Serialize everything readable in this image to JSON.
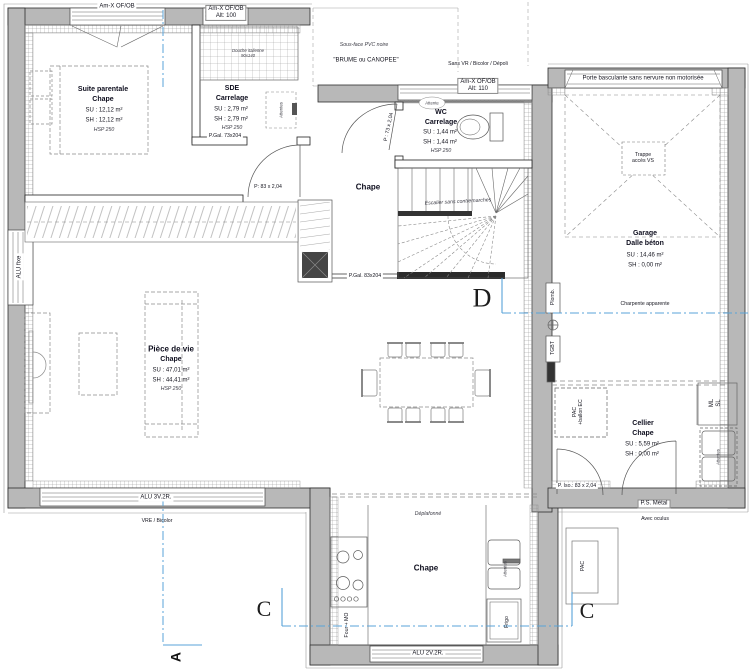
{
  "colors": {
    "wall_fill": "#b8b8b8",
    "section_blue": "#58a3d8",
    "ink": "#15151f"
  },
  "windows": {
    "w1": "Am-X OF/OB",
    "w2_line1": "Am-X OF/OB",
    "w2_line2": "Alt: 100",
    "w3_line1": "Am-X OF/OB",
    "w3_line2": "Alt: 110",
    "w3_note": "Sans VR / Bicolor / Dépoli",
    "alu_fixe": "ALU fixe",
    "alu_3v": "ALU 3V.2R.",
    "alu_3v_note": "VRE / Bicolor",
    "alu_2v": "ALU 2V.2R."
  },
  "doors": {
    "garage_door": "Porte basculante sans nervure non motorisée",
    "p_gal_sde": "P.Gal. 73x204",
    "p_suite": "P: 83 x 2,04",
    "p_wc": "P : 73 x 2,04",
    "p_gal_hall": "P.Gal. 83x204",
    "p_iso": "P. Iso.: 83 x 2,04",
    "ps_metal": "P.S. Métal",
    "ps_metal_note": "Avec oculus"
  },
  "rooms": {
    "suite": {
      "name": "Suite parentale",
      "floor": "Chape",
      "su": "SU : 12,12 m²",
      "sh": "SH : 12,12 m²",
      "hsp": "HSP 250"
    },
    "sde": {
      "name": "SDE",
      "floor": "Carrelage",
      "su": "SU : 2,79 m²",
      "sh": "SH : 2,79 m²",
      "hsp": "HSP 250"
    },
    "wc": {
      "name": "WC",
      "floor": "Carrelage",
      "su": "SU : 1,44 m²",
      "sh": "SH : 1,44 m²",
      "hsp": "HSP 250"
    },
    "hall": {
      "floor": "Chape"
    },
    "living": {
      "name": "Pièce de vie",
      "floor": "Chape",
      "su": "SU : 47,01 m²",
      "sh": "SH : 44,41 m²",
      "hsp": "HSP 250"
    },
    "kitchen": {
      "floor": "Chape"
    },
    "garage": {
      "name": "Garage",
      "floor": "Dalle béton",
      "su": "SU : 14,46 m²",
      "sh": "SH : 0,00 m²"
    },
    "cellier": {
      "name": "Cellier",
      "floor": "Chape",
      "su": "SU : 5,59 m²",
      "sh": "SH : 0,00 m²"
    }
  },
  "annotations": {
    "soffit": "Sous-face PVC noire",
    "brand": "\"BRUME ou CANOPEE\"",
    "trappe_1": "Trappe",
    "trappe_2": "accès VS",
    "charpente": "Charpente apparente",
    "stairs": "Escalier sans contremarches",
    "shower_1": "Douche italienne",
    "shower_2": "90x140",
    "deplafonne": "Déplafonné",
    "attentes": "Attentes",
    "attente": "Attente"
  },
  "equipment": {
    "pac_closet_1": "PAC",
    "pac_closet_2": "+ballon EC",
    "ml": "ML",
    "sl": "SL",
    "plomb": "Plomb.",
    "tgbt": "TGBT",
    "four": "Four + MO",
    "frigo": "Frigo",
    "pac_ext": "PAC"
  },
  "sections": {
    "a": "A",
    "c": "C",
    "d": "D"
  }
}
